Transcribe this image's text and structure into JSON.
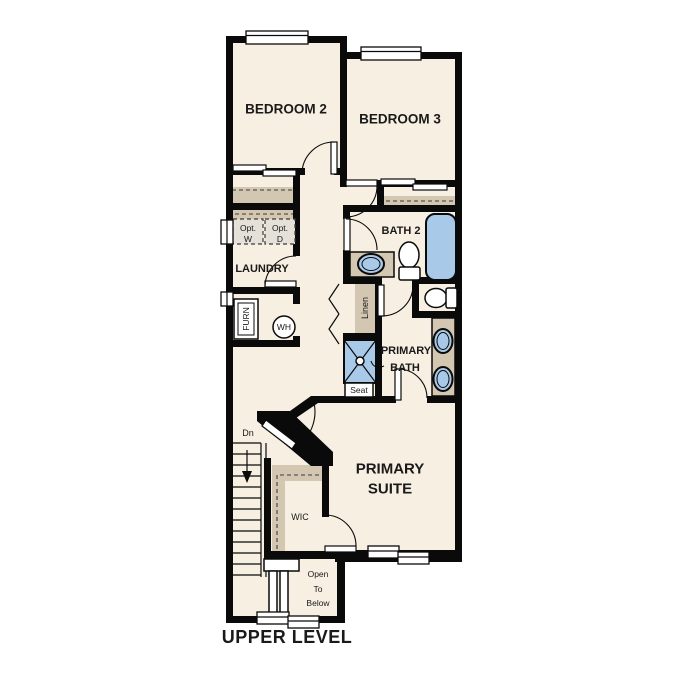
{
  "plan": {
    "title": "UPPER LEVEL",
    "rooms": {
      "bedroom2": "BEDROOM 2",
      "bedroom3": "BEDROOM 3",
      "bath2": "BATH 2",
      "laundry": "LAUNDRY",
      "primary_suite": [
        "PRIMARY",
        "SUITE"
      ],
      "primary_bath": [
        "PRIMARY",
        "BATH"
      ],
      "wic": "WIC",
      "linen": "Linen",
      "open_to_below": [
        "Open",
        "To",
        "Below"
      ]
    },
    "labels": {
      "stairs_dn": "Dn",
      "shower_seat": "Seat",
      "furnace": "FURN",
      "water_heater": "WH",
      "opt_washer": [
        "Opt.",
        "W"
      ],
      "opt_dryer": [
        "Opt.",
        "D"
      ]
    },
    "colors": {
      "floor": "#F7EFE2",
      "cabinet_tan": "#D4C7B1",
      "fixture_blue": "#A9C9E8",
      "optional_appliance_fill": "#E5E1D9",
      "wall": "#0A0A0A",
      "text": "#1A1A1A"
    }
  }
}
